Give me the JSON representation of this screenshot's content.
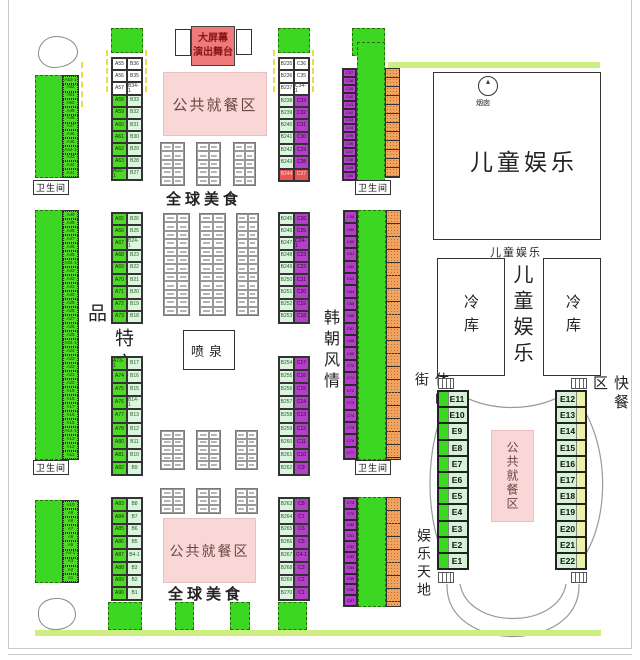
{
  "labels": {
    "stage_line1": "大屏幕",
    "stage_line2": "演出舞台",
    "public_dining": "公共就餐区",
    "global_food": "全球美食",
    "kids_zone": "儿童娱乐",
    "chimney": "烟囱",
    "cold_storage": "冷库",
    "farm_products": "农特产品",
    "fountain": "喷泉",
    "restroom": "卫生间",
    "korea_style": "韩朝风情",
    "leisure_street": "休闲街",
    "fast_food": "快餐区",
    "fun_world": "娱乐天地"
  },
  "colors": {
    "booth_green": "#3CD723",
    "booth_pale_green": "#DDF5E0",
    "booth_purple": "#B43FC8",
    "booth_orange": "#F1A35F",
    "stage_red": "#EE7A7A",
    "dining_pink": "#F9D7D7",
    "accent_bar_green": "#CDEF82",
    "e_strip_yellow": "#EEF2A8",
    "special_row_red": "#E85555"
  },
  "booths": {
    "a_col_top": [
      "A53-1",
      "A52",
      "A51",
      "A50",
      "A49",
      "A48",
      "A47",
      "A46",
      "A45",
      "A44-1",
      "A43",
      "A42",
      "A41"
    ],
    "a_col_mid": [
      "A40",
      "A39",
      "A38",
      "A37",
      "A36",
      "A35",
      "A34-1",
      "A33",
      "A32",
      "A31",
      "A30",
      "A29",
      "A28",
      "A27",
      "A26",
      "A25",
      "A24-1",
      "A24",
      "A23",
      "A22",
      "A21",
      "A20",
      "A19",
      "A18",
      "A17",
      "A16",
      "A15",
      "A14-1",
      "A13",
      "A12",
      "A11"
    ],
    "a_col_bottom": [
      "A10",
      "A9",
      "A8",
      "A7",
      "A6",
      "A5",
      "A4-1",
      "A3",
      "A2",
      "A1"
    ],
    "ab_top": [
      [
        "A55",
        "B36",
        "w"
      ],
      [
        "A56",
        "B35",
        "w"
      ],
      [
        "A57",
        "B34-1",
        "w"
      ],
      [
        "A58",
        "B33"
      ],
      [
        "A59",
        "B32"
      ],
      [
        "A60",
        "B31"
      ],
      [
        "A61",
        "B30"
      ],
      [
        "A62",
        "B29"
      ],
      [
        "A63",
        "B28"
      ],
      [
        "A65-1",
        "B27"
      ]
    ],
    "ab_mid_upper": [
      [
        "A65",
        "B26"
      ],
      [
        "A66",
        "B25"
      ],
      [
        "A67",
        "B24-1"
      ],
      [
        "A68",
        "B23"
      ],
      [
        "A69",
        "B22"
      ],
      [
        "A70",
        "B21"
      ],
      [
        "A71",
        "B20"
      ],
      [
        "A72",
        "B19"
      ],
      [
        "A73",
        "B18"
      ]
    ],
    "ab_mid_lower": [
      [
        "A73-1",
        "B17"
      ],
      [
        "A74",
        "B16"
      ],
      [
        "A75",
        "B15"
      ],
      [
        "A76",
        "B14-1"
      ],
      [
        "A77",
        "B13"
      ],
      [
        "A78",
        "B12"
      ],
      [
        "A80",
        "B11"
      ],
      [
        "A81",
        "B10"
      ],
      [
        "A82",
        "B9"
      ]
    ],
    "ab_bottom": [
      [
        "A83",
        "B8"
      ],
      [
        "A84",
        "B7"
      ],
      [
        "A85",
        "B6"
      ],
      [
        "A86",
        "B5"
      ],
      [
        "A87",
        "B4-1"
      ],
      [
        "A88",
        "B3"
      ],
      [
        "A89",
        "B2"
      ],
      [
        "A90",
        "B1"
      ]
    ],
    "bc_top": [
      [
        "B235",
        "C36",
        "w"
      ],
      [
        "B236",
        "C35",
        "w"
      ],
      [
        "B237",
        "C34-1",
        "w"
      ],
      [
        "B238",
        "C33"
      ],
      [
        "B239",
        "C32"
      ],
      [
        "B240",
        "C31"
      ],
      [
        "B241",
        "C30"
      ],
      [
        "B242",
        "C29"
      ],
      [
        "B243",
        "C28"
      ],
      [
        "B244",
        "C27",
        "r"
      ]
    ],
    "bc_mid_upper": [
      [
        "B245",
        "C26"
      ],
      [
        "B246",
        "C25"
      ],
      [
        "B247",
        "C24-1"
      ],
      [
        "B248",
        "C23"
      ],
      [
        "B249",
        "C22"
      ],
      [
        "B250",
        "C21"
      ],
      [
        "B251",
        "C20"
      ],
      [
        "B252",
        "C19"
      ],
      [
        "B253",
        "C18"
      ]
    ],
    "bc_mid_lower": [
      [
        "B254",
        "C17"
      ],
      [
        "B255",
        "C16"
      ],
      [
        "B256",
        "C15"
      ],
      [
        "B257",
        "C14"
      ],
      [
        "B258",
        "C13"
      ],
      [
        "B259",
        "C12"
      ],
      [
        "B260",
        "C11"
      ],
      [
        "B261",
        "C10"
      ],
      [
        "B262",
        "C9"
      ]
    ],
    "bc_bottom": [
      [
        "B263",
        "C8"
      ],
      [
        "B264",
        "C7"
      ],
      [
        "B265",
        "C6"
      ],
      [
        "B266",
        "C5"
      ],
      [
        "B267",
        "C4-1"
      ],
      [
        "B268",
        "C3"
      ],
      [
        "B269",
        "C2"
      ],
      [
        "B270",
        "C1"
      ]
    ],
    "c_col_top": [
      "C37",
      "C38",
      "C39",
      "C40",
      "C41",
      "C42",
      "C43",
      "C44",
      "C45",
      "C46",
      "C47",
      "C48",
      "C49",
      "C50"
    ],
    "c_col_mid": [
      "C58",
      "C59",
      "C60",
      "C61",
      "C62",
      "C63",
      "C64",
      "C65",
      "C66",
      "C67",
      "C68",
      "C69",
      "C70",
      "C71",
      "C72",
      "C73",
      "C74",
      "C75",
      "C76",
      "C77"
    ],
    "c_col_bottom": [
      "C78",
      "C79",
      "C80",
      "C81",
      "C82",
      "C83",
      "C84",
      "C85",
      "C86",
      "C87"
    ],
    "e_left": [
      "E11",
      "E10",
      "E9",
      "E8",
      "E7",
      "E6",
      "E5",
      "E4",
      "E3",
      "E2",
      "E1"
    ],
    "e_right": [
      "E12",
      "E13",
      "E14",
      "E15",
      "E16",
      "E17",
      "E18",
      "E19",
      "E20",
      "E21",
      "E22"
    ]
  }
}
